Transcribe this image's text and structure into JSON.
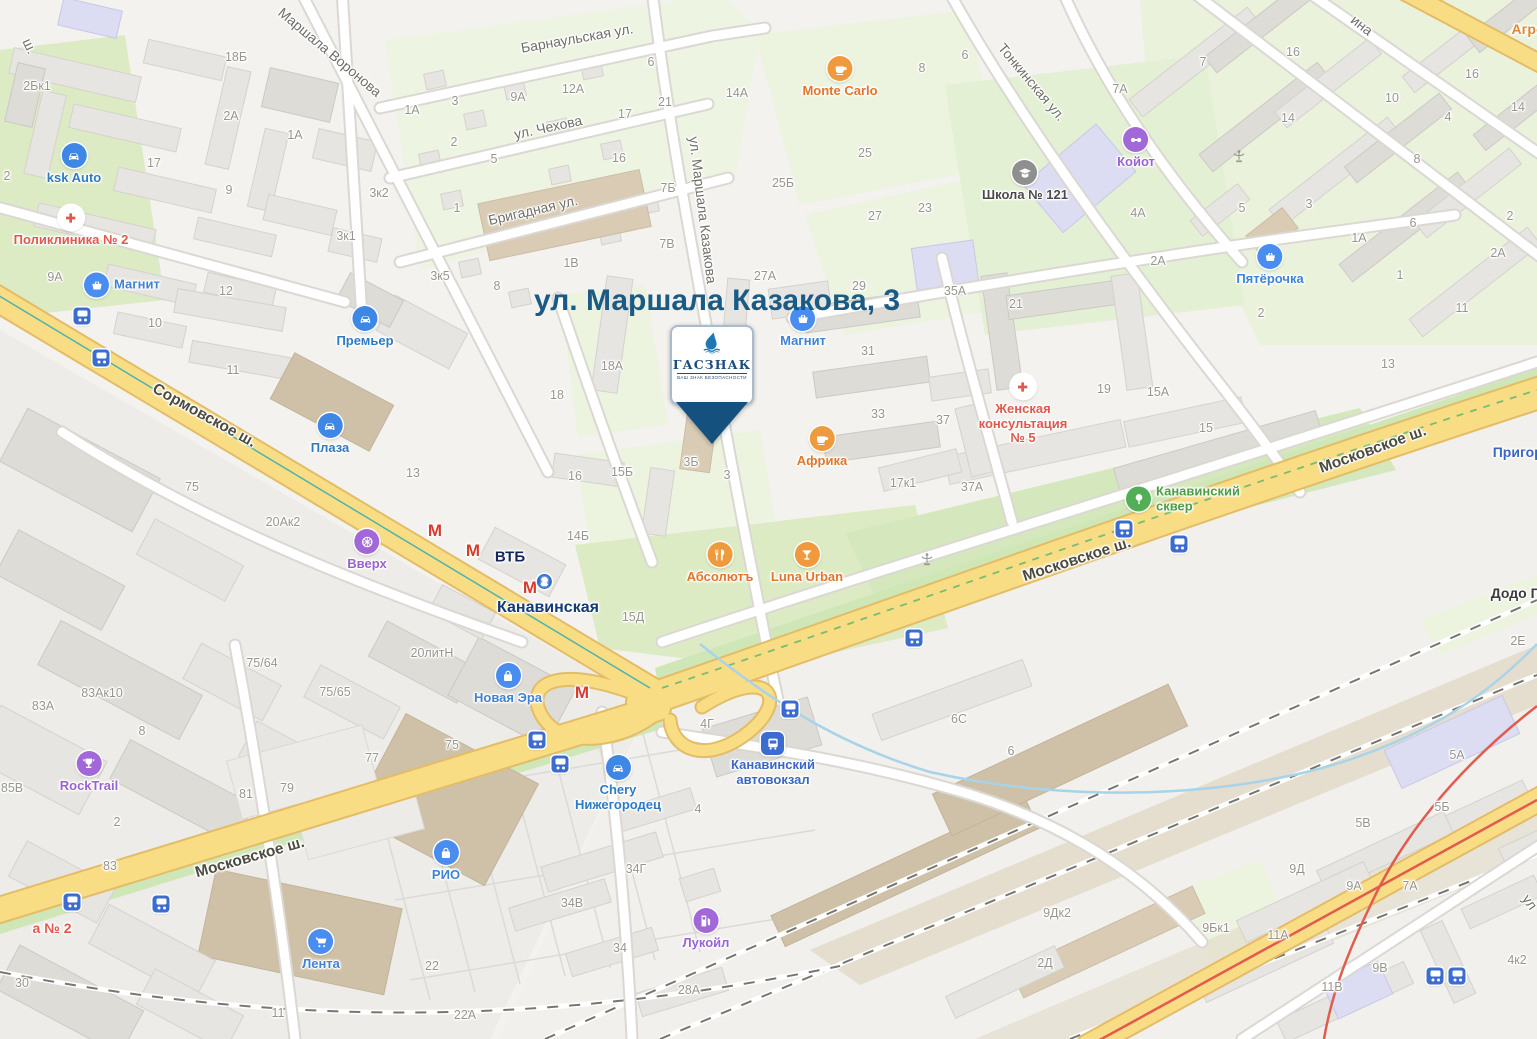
{
  "map": {
    "title": "ул. Маршала Казакова, 3",
    "marker": {
      "name": "ГАСЗНАК",
      "tagline": "ВАШ ЗНАК БЕЗОПАСНОСТИ"
    },
    "colors": {
      "road_major": "#f9dd85",
      "green": "#dcebc4",
      "building": "#e7e5e1",
      "accent_blue": "#3f87e5",
      "accent_orange": "#f09a3e",
      "accent_purple": "#a368d8",
      "accent_red": "#e2574c",
      "metro_red": "#d93a2b",
      "transit_blue": "#3d6cd1",
      "title_blue": "#1a5b86",
      "pin_navy": "#15517f"
    },
    "street_labels": [
      {
        "t": "Маршала Воронова",
        "x": 330,
        "y": 52,
        "r": 40
      },
      {
        "t": "Барнаульская ул.",
        "x": 577,
        "y": 38,
        "r": -10
      },
      {
        "t": "ул. Чехова",
        "x": 548,
        "y": 127,
        "r": -12
      },
      {
        "t": "Бригадная ул.",
        "x": 533,
        "y": 210,
        "r": -13
      },
      {
        "t": "ул. Маршала Казакова",
        "x": 703,
        "y": 210,
        "r": 83
      },
      {
        "t": "Тонкинская ул.",
        "x": 1032,
        "y": 82,
        "r": 50
      },
      {
        "t": "Сормовское ш.",
        "x": 204,
        "y": 416,
        "r": 29,
        "hw": 1
      },
      {
        "t": "Московское ш.",
        "x": 1077,
        "y": 560,
        "r": -18,
        "hw": 1
      },
      {
        "t": "Московское ш.",
        "x": 1373,
        "y": 450,
        "r": -20,
        "hw": 1
      },
      {
        "t": "Московское ш.",
        "x": 250,
        "y": 858,
        "r": -16,
        "hw": 1
      },
      {
        "t": "ш.",
        "x": 30,
        "y": 46,
        "r": 65
      },
      {
        "t": "ина",
        "x": 1362,
        "y": 25,
        "r": 38
      },
      {
        "t": "ул",
        "x": 1530,
        "y": 902,
        "r": 55
      }
    ],
    "building_labels": [
      [
        "2Бк1",
        37,
        86
      ],
      [
        "18Б",
        236,
        57
      ],
      [
        "2А",
        231,
        116
      ],
      [
        "1А",
        295,
        135
      ],
      [
        "17",
        154,
        163
      ],
      [
        "9",
        229,
        190
      ],
      [
        "3к2",
        379,
        193
      ],
      [
        "3к1",
        346,
        236
      ],
      [
        "9А",
        55,
        277
      ],
      [
        "10",
        155,
        323
      ],
      [
        "12",
        226,
        291
      ],
      [
        "11",
        233,
        370
      ],
      [
        "2",
        7,
        176
      ],
      [
        "1А",
        412,
        110
      ],
      [
        "3",
        455,
        101
      ],
      [
        "9А",
        518,
        97
      ],
      [
        "12А",
        573,
        89
      ],
      [
        "6",
        651,
        62
      ],
      [
        "2",
        454,
        142
      ],
      [
        "17",
        625,
        114
      ],
      [
        "21",
        665,
        102
      ],
      [
        "5",
        494,
        159
      ],
      [
        "16",
        619,
        158
      ],
      [
        "14А",
        737,
        93
      ],
      [
        "1",
        457,
        208
      ],
      [
        "7Б",
        668,
        188
      ],
      [
        "25Б",
        783,
        183
      ],
      [
        "3к5",
        440,
        276
      ],
      [
        "8",
        497,
        286
      ],
      [
        "1В",
        571,
        263
      ],
      [
        "7В",
        667,
        244
      ],
      [
        "27А",
        765,
        276
      ],
      [
        "8",
        922,
        68
      ],
      [
        "6",
        965,
        55
      ],
      [
        "7А",
        1120,
        89
      ],
      [
        "25",
        865,
        153
      ],
      [
        "27",
        875,
        216
      ],
      [
        "23",
        925,
        208
      ],
      [
        "4А",
        1138,
        213
      ],
      [
        "2А",
        1158,
        261
      ],
      [
        "29",
        859,
        286
      ],
      [
        "35А",
        955,
        291
      ],
      [
        "7",
        1203,
        62
      ],
      [
        "16",
        1293,
        52
      ],
      [
        "10",
        1392,
        98
      ],
      [
        "16",
        1472,
        74
      ],
      [
        "14",
        1288,
        118
      ],
      [
        "4",
        1448,
        117
      ],
      [
        "14",
        1518,
        107
      ],
      [
        "8",
        1417,
        159
      ],
      [
        "5",
        1242,
        208
      ],
      [
        "3",
        1309,
        204
      ],
      [
        "2",
        1510,
        216
      ],
      [
        "1А",
        1359,
        238
      ],
      [
        "6",
        1413,
        223
      ],
      [
        "2А",
        1498,
        253
      ],
      [
        "1",
        1400,
        275
      ],
      [
        "11",
        1462,
        308
      ],
      [
        "2",
        1261,
        313
      ],
      [
        "18А",
        612,
        366
      ],
      [
        "18",
        557,
        395
      ],
      [
        "31",
        868,
        351
      ],
      [
        "33",
        878,
        414
      ],
      [
        "3Б",
        691,
        462
      ],
      [
        "3",
        727,
        475
      ],
      [
        "15Б",
        622,
        472
      ],
      [
        "16",
        575,
        476
      ],
      [
        "14Б",
        578,
        536
      ],
      [
        "15Д",
        633,
        617
      ],
      [
        "17к1",
        903,
        483
      ],
      [
        "37А",
        972,
        487
      ],
      [
        "37",
        943,
        420
      ],
      [
        "21",
        1016,
        304
      ],
      [
        "19",
        1104,
        389
      ],
      [
        "15А",
        1158,
        392
      ],
      [
        "15",
        1206,
        428
      ],
      [
        "13",
        1388,
        364
      ],
      [
        "2Е",
        1518,
        641
      ],
      [
        "20Ак2",
        283,
        522
      ],
      [
        "75",
        192,
        487
      ],
      [
        "13",
        413,
        473
      ],
      [
        "20литН",
        432,
        653
      ],
      [
        "75",
        452,
        745
      ],
      [
        "4Г",
        707,
        724
      ],
      [
        "4",
        698,
        809
      ],
      [
        "75/64",
        262,
        663
      ],
      [
        "75/65",
        335,
        692
      ],
      [
        "77",
        372,
        758
      ],
      [
        "79",
        287,
        788
      ],
      [
        "81",
        246,
        794
      ],
      [
        "8",
        142,
        731
      ],
      [
        "83А",
        43,
        706
      ],
      [
        "83Ак10",
        102,
        693
      ],
      [
        "85В",
        12,
        788
      ],
      [
        "2",
        117,
        822
      ],
      [
        "30",
        22,
        983
      ],
      [
        "83",
        110,
        866
      ],
      [
        "22",
        432,
        966
      ],
      [
        "22А",
        465,
        1015
      ],
      [
        "11",
        278,
        1013
      ],
      [
        "34Г",
        636,
        869
      ],
      [
        "34В",
        572,
        903
      ],
      [
        "34",
        620,
        948
      ],
      [
        "28А",
        689,
        990
      ],
      [
        "6С",
        959,
        719
      ],
      [
        "6",
        1011,
        751
      ],
      [
        "5А",
        1457,
        755
      ],
      [
        "5Б",
        1442,
        807
      ],
      [
        "5В",
        1363,
        823
      ],
      [
        "9Д",
        1297,
        869
      ],
      [
        "9А",
        1354,
        886
      ],
      [
        "7А",
        1410,
        886
      ],
      [
        "9Бк1",
        1216,
        928
      ],
      [
        "11А",
        1278,
        935
      ],
      [
        "9В",
        1380,
        968
      ],
      [
        "11В",
        1332,
        987
      ],
      [
        "4к2",
        1517,
        960
      ],
      [
        "9Дк2",
        1057,
        913
      ],
      [
        "2Д",
        1045,
        963
      ]
    ],
    "pois": [
      {
        "t": [
          "ksk Auto"
        ],
        "x": 74,
        "y": 156,
        "icon": "car",
        "bg": "#3f87e5",
        "lc": "#2f7ac4"
      },
      {
        "t": [
          "Поликлиника № 2"
        ],
        "x": 71,
        "y": 218,
        "icon": "cross",
        "bg": "#ffffff",
        "gc": "#e2574c",
        "lc": "#e2574c"
      },
      {
        "t": [
          "Магнит"
        ],
        "x": 97,
        "y": 285,
        "icon": "basket",
        "bg": "#4a8df0",
        "lc": "#3f82d6",
        "side": "right"
      },
      {
        "t": [
          "Премьер"
        ],
        "x": 365,
        "y": 319,
        "icon": "car",
        "bg": "#3f87e5",
        "lc": "#2f7ac4"
      },
      {
        "t": [
          "Плаза"
        ],
        "x": 330,
        "y": 426,
        "icon": "car",
        "bg": "#3f87e5",
        "lc": "#2f7ac4"
      },
      {
        "t": [
          "Вверх"
        ],
        "x": 367,
        "y": 542,
        "icon": "wheel",
        "bg": "#a368d8",
        "lc": "#9a63d4"
      },
      {
        "t": [
          "Новая Эра"
        ],
        "x": 508,
        "y": 676,
        "icon": "bag",
        "bg": "#4a8df0",
        "lc": "#3f82d6"
      },
      {
        "t": [
          "Абсолютъ"
        ],
        "x": 720,
        "y": 555,
        "icon": "forkknife",
        "bg": "#f09a3e",
        "lc": "#e0762c"
      },
      {
        "t": [
          "Luna Urban"
        ],
        "x": 807,
        "y": 555,
        "icon": "cocktail",
        "bg": "#f09a3e",
        "lc": "#e0762c"
      },
      {
        "t": [
          "Chery",
          "Нижегородец"
        ],
        "x": 618,
        "y": 768,
        "icon": "car",
        "bg": "#3f87e5",
        "lc": "#2f7ac4"
      },
      {
        "t": [
          "Канавинский",
          "автовокзал"
        ],
        "x": 773,
        "y": 745,
        "icon": "bus",
        "bg": "#3d6cd1",
        "lc": "#3a66c4",
        "sq": 1
      },
      {
        "t": [
          "Лукойл"
        ],
        "x": 706,
        "y": 921,
        "icon": "fuel",
        "bg": "#a368d8",
        "lc": "#9a63d4"
      },
      {
        "t": [
          "Лента"
        ],
        "x": 321,
        "y": 942,
        "icon": "cart",
        "bg": "#4a8df0",
        "lc": "#3f82d6"
      },
      {
        "t": [
          "РИО"
        ],
        "x": 446,
        "y": 853,
        "icon": "bag",
        "bg": "#4a8df0",
        "lc": "#3f82d6"
      },
      {
        "t": [
          "RockTrail"
        ],
        "x": 89,
        "y": 764,
        "icon": "trophy",
        "bg": "#a368d8",
        "lc": "#9a63d4"
      },
      {
        "t": [
          "Monte Carlo"
        ],
        "x": 840,
        "y": 69,
        "icon": "cup",
        "bg": "#f09a3e",
        "lc": "#e0762c"
      },
      {
        "t": [
          "Школа № 121"
        ],
        "x": 1025,
        "y": 173,
        "icon": "school",
        "bg": "#8f8f8f",
        "lc": "#4a4a4a"
      },
      {
        "t": [
          "Койот"
        ],
        "x": 1136,
        "y": 140,
        "icon": "pads",
        "bg": "#a368d8",
        "lc": "#9a63d4"
      },
      {
        "t": [
          "Пятёрочка"
        ],
        "x": 1270,
        "y": 257,
        "icon": "basket",
        "bg": "#4a8df0",
        "lc": "#3f82d6"
      },
      {
        "t": [
          "Магнит"
        ],
        "x": 803,
        "y": 319,
        "icon": "basket",
        "bg": "#4a8df0",
        "lc": "#3f82d6"
      },
      {
        "t": [
          "Африка"
        ],
        "x": 822,
        "y": 439,
        "icon": "cup",
        "bg": "#f09a3e",
        "lc": "#e0762c"
      },
      {
        "t": [
          "Женская",
          "консультация",
          "№ 5"
        ],
        "x": 1023,
        "y": 387,
        "icon": "cross",
        "bg": "#ffffff",
        "gc": "#e2574c",
        "lc": "#e2574c"
      },
      {
        "t": [
          "Канавинский",
          "сквер"
        ],
        "x": 1139,
        "y": 499,
        "icon": "tree",
        "bg": "#52ae57",
        "lc": "#4d9e43",
        "side": "right"
      }
    ],
    "plain_labels": [
      {
        "t": "Канавинская",
        "x": 548,
        "y": 608,
        "c": "#123a78",
        "fs": 16
      },
      {
        "t": "ВТБ",
        "x": 510,
        "y": 557,
        "c": "#14265e",
        "fs": 15
      },
      {
        "t": "Пригоро",
        "x": 1522,
        "y": 452,
        "c": "#3a66c4",
        "fs": 14
      },
      {
        "t": "Додо Пи",
        "x": 1520,
        "y": 593,
        "c": "#3c3c3c",
        "fs": 14
      },
      {
        "t": "Агро",
        "x": 1528,
        "y": 29,
        "c": "#e08734",
        "fs": 14
      },
      {
        "t": "а № 2",
        "x": 52,
        "y": 928,
        "c": "#e2574c",
        "fs": 14
      }
    ],
    "transit_stops": [
      {
        "x": 82,
        "y": 316
      },
      {
        "x": 101,
        "y": 358
      },
      {
        "x": 537,
        "y": 740
      },
      {
        "x": 560,
        "y": 764
      },
      {
        "x": 790,
        "y": 709
      },
      {
        "x": 914,
        "y": 638
      },
      {
        "x": 1124,
        "y": 529
      },
      {
        "x": 1179,
        "y": 544
      },
      {
        "x": 72,
        "y": 902
      },
      {
        "x": 161,
        "y": 904
      },
      {
        "x": 1435,
        "y": 976
      },
      {
        "x": 1457,
        "y": 976
      }
    ],
    "metro_marks": [
      {
        "x": 435,
        "y": 531
      },
      {
        "x": 473,
        "y": 551
      },
      {
        "x": 530,
        "y": 588,
        "badge": "2"
      },
      {
        "x": 582,
        "y": 693
      }
    ],
    "metro_letter": "М",
    "monuments": [
      {
        "x": 1239,
        "y": 159
      },
      {
        "x": 927,
        "y": 562
      }
    ]
  }
}
